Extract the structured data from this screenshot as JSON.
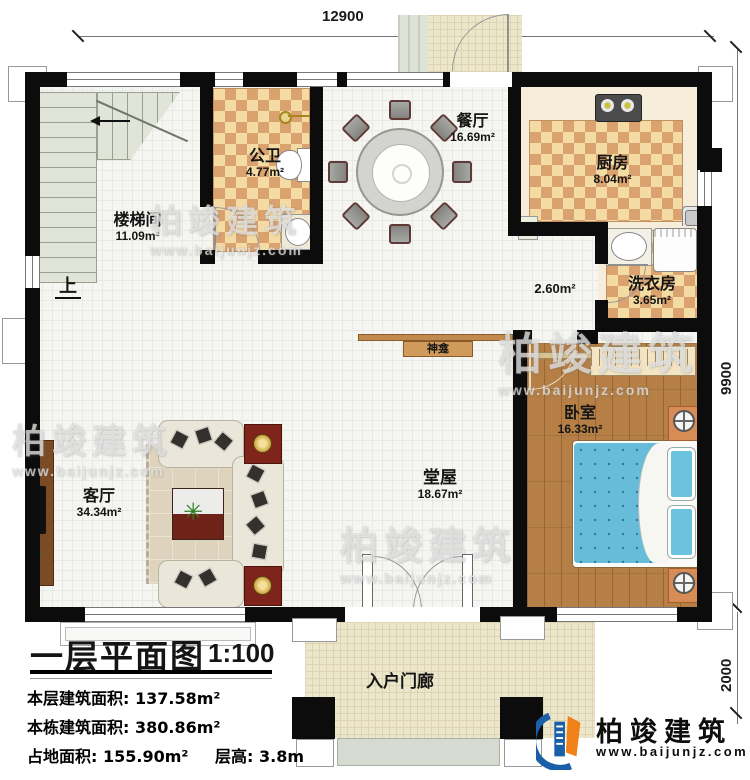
{
  "plan": {
    "title": "一层平面图",
    "scale": "1:100",
    "dims": {
      "top": "12900",
      "right": "9900",
      "porch": "2000"
    },
    "rooms": {
      "stair": {
        "name": "楼梯间",
        "area": "11.09m²"
      },
      "bath": {
        "name": "公卫",
        "area": "4.77m²"
      },
      "dining": {
        "name": "餐厅",
        "area": "16.69m²"
      },
      "kitchen": {
        "name": "厨房",
        "area": "8.04m²"
      },
      "laundry": {
        "name": "洗衣房",
        "area": "3.65m²"
      },
      "corridor": {
        "area": "2.60m²"
      },
      "bedroom": {
        "name": "卧室",
        "area": "16.33m²"
      },
      "hall": {
        "name": "堂屋",
        "area": "18.67m²"
      },
      "living": {
        "name": "客厅",
        "area": "34.34m²"
      },
      "porch": {
        "name": "入户门廊"
      }
    },
    "labels": {
      "shrine": "神龛",
      "up": "上"
    }
  },
  "title_block": {
    "rows": [
      {
        "label": "本层建筑面积:",
        "value": "137.58m²"
      },
      {
        "label": "本栋建筑面积:",
        "value": "380.86m²"
      },
      {
        "label": "占地面积:",
        "value": "155.90m²"
      },
      {
        "label": "层高:",
        "value": "3.8m"
      }
    ]
  },
  "branding": {
    "logo_text": "柏竣建筑",
    "logo_url": "www.baijunjz.com",
    "watermark_text": "柏竣建筑",
    "watermark_url": "www.baijunjz.com",
    "blue": "#1b5fa8",
    "orange": "#f08119"
  }
}
